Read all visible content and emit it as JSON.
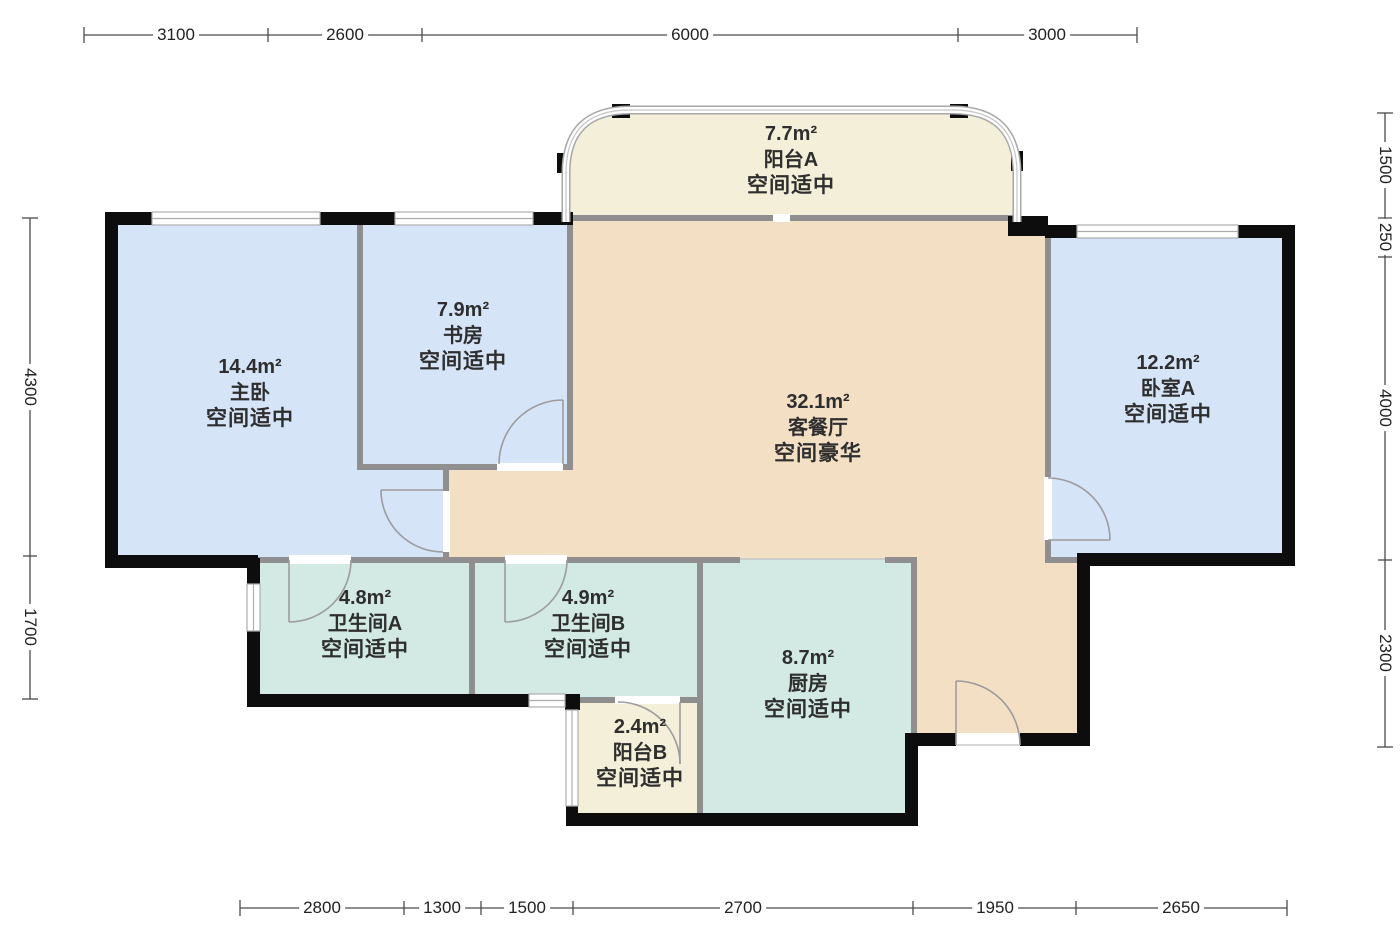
{
  "plan_title": "户型图",
  "colors": {
    "room_blue": "#d6e4f8",
    "room_tan": "#f2dfc4",
    "room_cream": "#f3efd8",
    "room_teal": "#d2eae3",
    "wall": "#0d0d0d",
    "wall_gray": "#8f8f8f",
    "window_line": "#adadad",
    "door_line": "#9c9c9c"
  },
  "rooms": [
    {
      "key": "balcony_a",
      "area": "7.7m²",
      "name": "阳台A",
      "grade": "空间适中"
    },
    {
      "key": "study",
      "area": "7.9m²",
      "name": "书房",
      "grade": "空间适中"
    },
    {
      "key": "master",
      "area": "14.4m²",
      "name": "主卧",
      "grade": "空间适中"
    },
    {
      "key": "living",
      "area": "32.1m²",
      "name": "客餐厅",
      "grade": "空间豪华"
    },
    {
      "key": "bedroom_a",
      "area": "12.2m²",
      "name": "卧室A",
      "grade": "空间适中"
    },
    {
      "key": "bath_a",
      "area": "4.8m²",
      "name": "卫生间A",
      "grade": "空间适中"
    },
    {
      "key": "bath_b",
      "area": "4.9m²",
      "name": "卫生间B",
      "grade": "空间适中"
    },
    {
      "key": "kitchen",
      "area": "8.7m²",
      "name": "厨房",
      "grade": "空间适中"
    },
    {
      "key": "balcony_b",
      "area": "2.4m²",
      "name": "阳台B",
      "grade": "空间适中"
    }
  ],
  "dimensions": {
    "top": [
      "3100",
      "2600",
      "6000",
      "3000"
    ],
    "bottom": [
      "2800",
      "1300",
      "1500",
      "2700",
      "1950",
      "2650"
    ],
    "left": [
      "4300",
      "1700"
    ],
    "right": [
      "1500",
      "250",
      "4000",
      "2300"
    ]
  }
}
